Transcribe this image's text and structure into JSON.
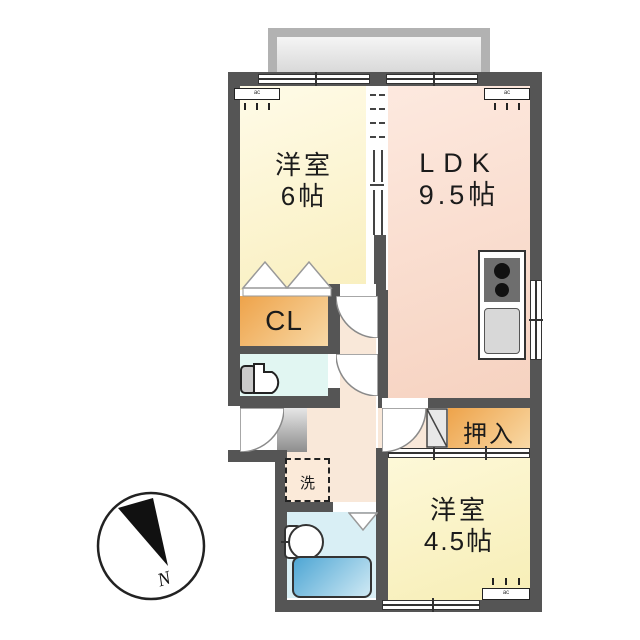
{
  "floorplan": {
    "title_hint": "apartment-floorplan",
    "rooms": [
      {
        "id": "western-room-6",
        "label": "洋室",
        "area": "6帖"
      },
      {
        "id": "ldk",
        "label": "LDK",
        "area": "9.5帖"
      },
      {
        "id": "western-room-45",
        "label": "洋室",
        "area": "4.5帖"
      }
    ],
    "closet_label": "CL",
    "oshiire_label": "押入",
    "laundry_label": "洗",
    "compass_label": "N",
    "aircon_text": "ac",
    "fixtures": [
      "balcony",
      "sliding-window",
      "toilet",
      "washbasin",
      "bathtub",
      "folding-door",
      "stove-two-burner",
      "kitchen-sink",
      "washing-machine-space",
      "air-conditioner",
      "entrance-door",
      "swing-door",
      "sliding-closet-door",
      "bifold-closet-door",
      "compass-north"
    ],
    "colors": {
      "wall": "#555555",
      "room_yellow": "#f9efbf",
      "ldk_pink": "#f7d6c4",
      "closet_orange": "#eea34a",
      "hall_peach": "#f9e8d9",
      "toilet_cyan": "#e1f6f2",
      "bath_blue": "#d9eff5",
      "tub_blue": "#4ea6d4",
      "balcony_gray": "#b2b2b2",
      "genkan_gray": "#8d8d8d"
    }
  }
}
